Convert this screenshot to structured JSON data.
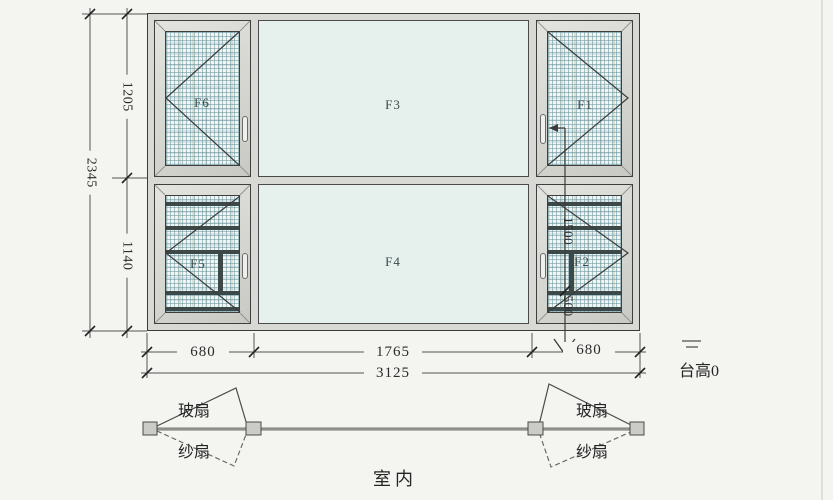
{
  "drawing": {
    "panel_labels": {
      "f1": "F1",
      "f2": "F2",
      "f3": "F3",
      "f4": "F4",
      "f5": "F5",
      "f6": "F6"
    },
    "dims": {
      "total_height": "2345",
      "upper_height": "1205",
      "lower_height": "1140",
      "left_width": "680",
      "center_width": "1765",
      "right_width": "680",
      "total_width": "3125",
      "inner_upper": "1500",
      "inner_lower": "500"
    },
    "notes": {
      "sill_height": "台高0",
      "indoor": "室内"
    },
    "plan": {
      "left": {
        "glass_sash": "玻扇",
        "screen_sash": "纱扇"
      },
      "right": {
        "glass_sash": "玻扇",
        "screen_sash": "纱扇"
      }
    },
    "colors": {
      "background": "#f4f4f1",
      "frame": "#d8d8d4",
      "glass": "#e6f1ed",
      "mesh_line": "#68949e",
      "line": "#3c3c3c"
    }
  }
}
